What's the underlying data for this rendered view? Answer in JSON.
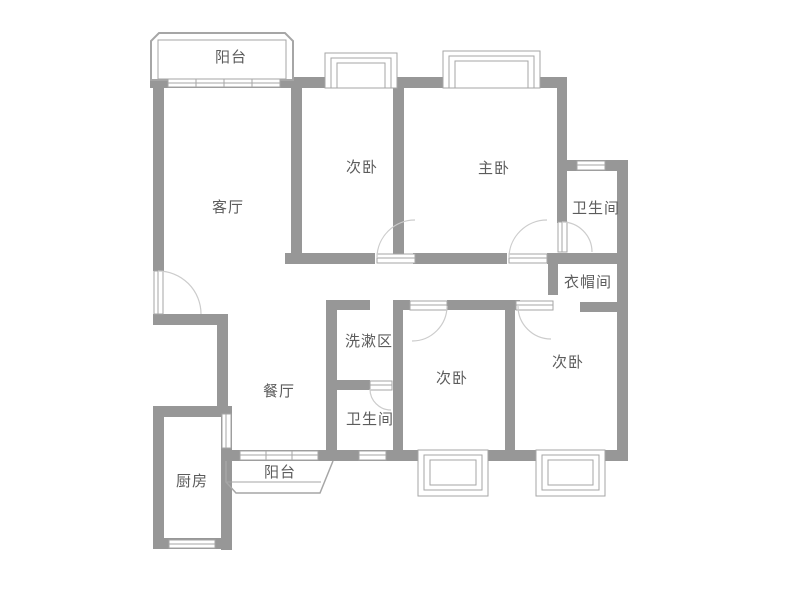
{
  "floorplan": {
    "type": "apartment-floor-plan",
    "language": "zh-CN",
    "rooms": [
      {
        "id": "balcony-top",
        "label": "阳台"
      },
      {
        "id": "bedroom-top-middle",
        "label": "次卧"
      },
      {
        "id": "master-bedroom",
        "label": "主卧"
      },
      {
        "id": "bathroom-upper",
        "label": "卫生间"
      },
      {
        "id": "living-room",
        "label": "客厅"
      },
      {
        "id": "cloakroom",
        "label": "衣帽间"
      },
      {
        "id": "wash-area",
        "label": "洗漱区"
      },
      {
        "id": "dining-room",
        "label": "餐厅"
      },
      {
        "id": "bedroom-bottom-middle",
        "label": "次卧"
      },
      {
        "id": "bedroom-bottom-right",
        "label": "次卧"
      },
      {
        "id": "bathroom-lower",
        "label": "卫生间"
      },
      {
        "id": "balcony-bottom",
        "label": "阳台"
      },
      {
        "id": "kitchen",
        "label": "厨房"
      }
    ],
    "colors": {
      "wall": "#979797",
      "label": "#5c5c5c",
      "fixture_line": "#a6a6a6",
      "arc": "#cccccc",
      "background": "#ffffff"
    }
  }
}
